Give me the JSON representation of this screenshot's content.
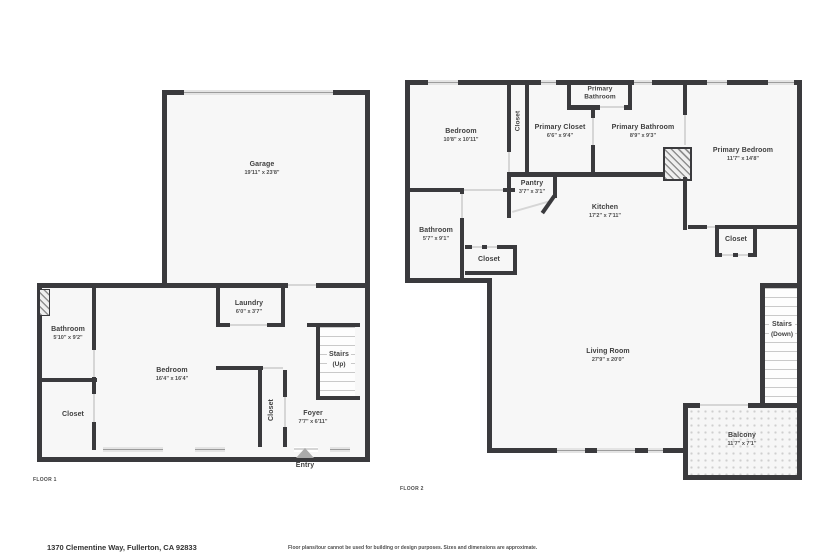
{
  "footer": {
    "address": "1370 Clementine Way, Fullerton, CA 92833",
    "disclaimer": "Floor plans/tour cannot be used for building or design purposes. Sizes and dimensions are approximate."
  },
  "colors": {
    "wall": "#3a3a3d",
    "floor_fill": "#f7f7f7"
  },
  "floor1": {
    "label": "FLOOR 1",
    "entry": "Entry",
    "rooms": {
      "garage": {
        "name": "Garage",
        "dims": "19'11\" x 23'8\""
      },
      "bathroom": {
        "name": "Bathroom",
        "dims": "5'10\" x 9'2\""
      },
      "closet": {
        "name": "Closet"
      },
      "bedroom": {
        "name": "Bedroom",
        "dims": "16'4\" x 16'4\""
      },
      "laundry": {
        "name": "Laundry",
        "dims": "6'0\" x 3'7\""
      },
      "stairs": {
        "name": "Stairs",
        "dims": "(Up)"
      },
      "foyer_closet": {
        "name": "Closet"
      },
      "foyer": {
        "name": "Foyer",
        "dims": "7'7\" x 6'11\""
      }
    }
  },
  "floor2": {
    "label": "FLOOR 2",
    "rooms": {
      "bedroom": {
        "name": "Bedroom",
        "dims": "10'8\" x 10'11\""
      },
      "hall_closet": {
        "name": "Closet"
      },
      "primary_bath_wc": {
        "name": "Primary Bathroom"
      },
      "primary_closet": {
        "name": "Primary Closet",
        "dims": "6'6\" x 9'4\""
      },
      "primary_bathroom": {
        "name": "Primary Bathroom",
        "dims": "8'9\" x 9'3\""
      },
      "primary_bedroom": {
        "name": "Primary Bedroom",
        "dims": "11'7\" x 14'8\""
      },
      "pantry": {
        "name": "Pantry",
        "dims": "3'7\" x 3'1\""
      },
      "kitchen": {
        "name": "Kitchen",
        "dims": "17'2\" x 7'11\""
      },
      "bathroom": {
        "name": "Bathroom",
        "dims": "5'7\" x 9'1\""
      },
      "bath_closet": {
        "name": "Closet"
      },
      "bedroom_closet": {
        "name": "Closet"
      },
      "living_room": {
        "name": "Living Room",
        "dims": "27'9\" x 20'0\""
      },
      "stairs": {
        "name": "Stairs",
        "dims": "(Down)"
      },
      "balcony": {
        "name": "Balcony",
        "dims": "11'7\" x 7'1\""
      }
    }
  }
}
